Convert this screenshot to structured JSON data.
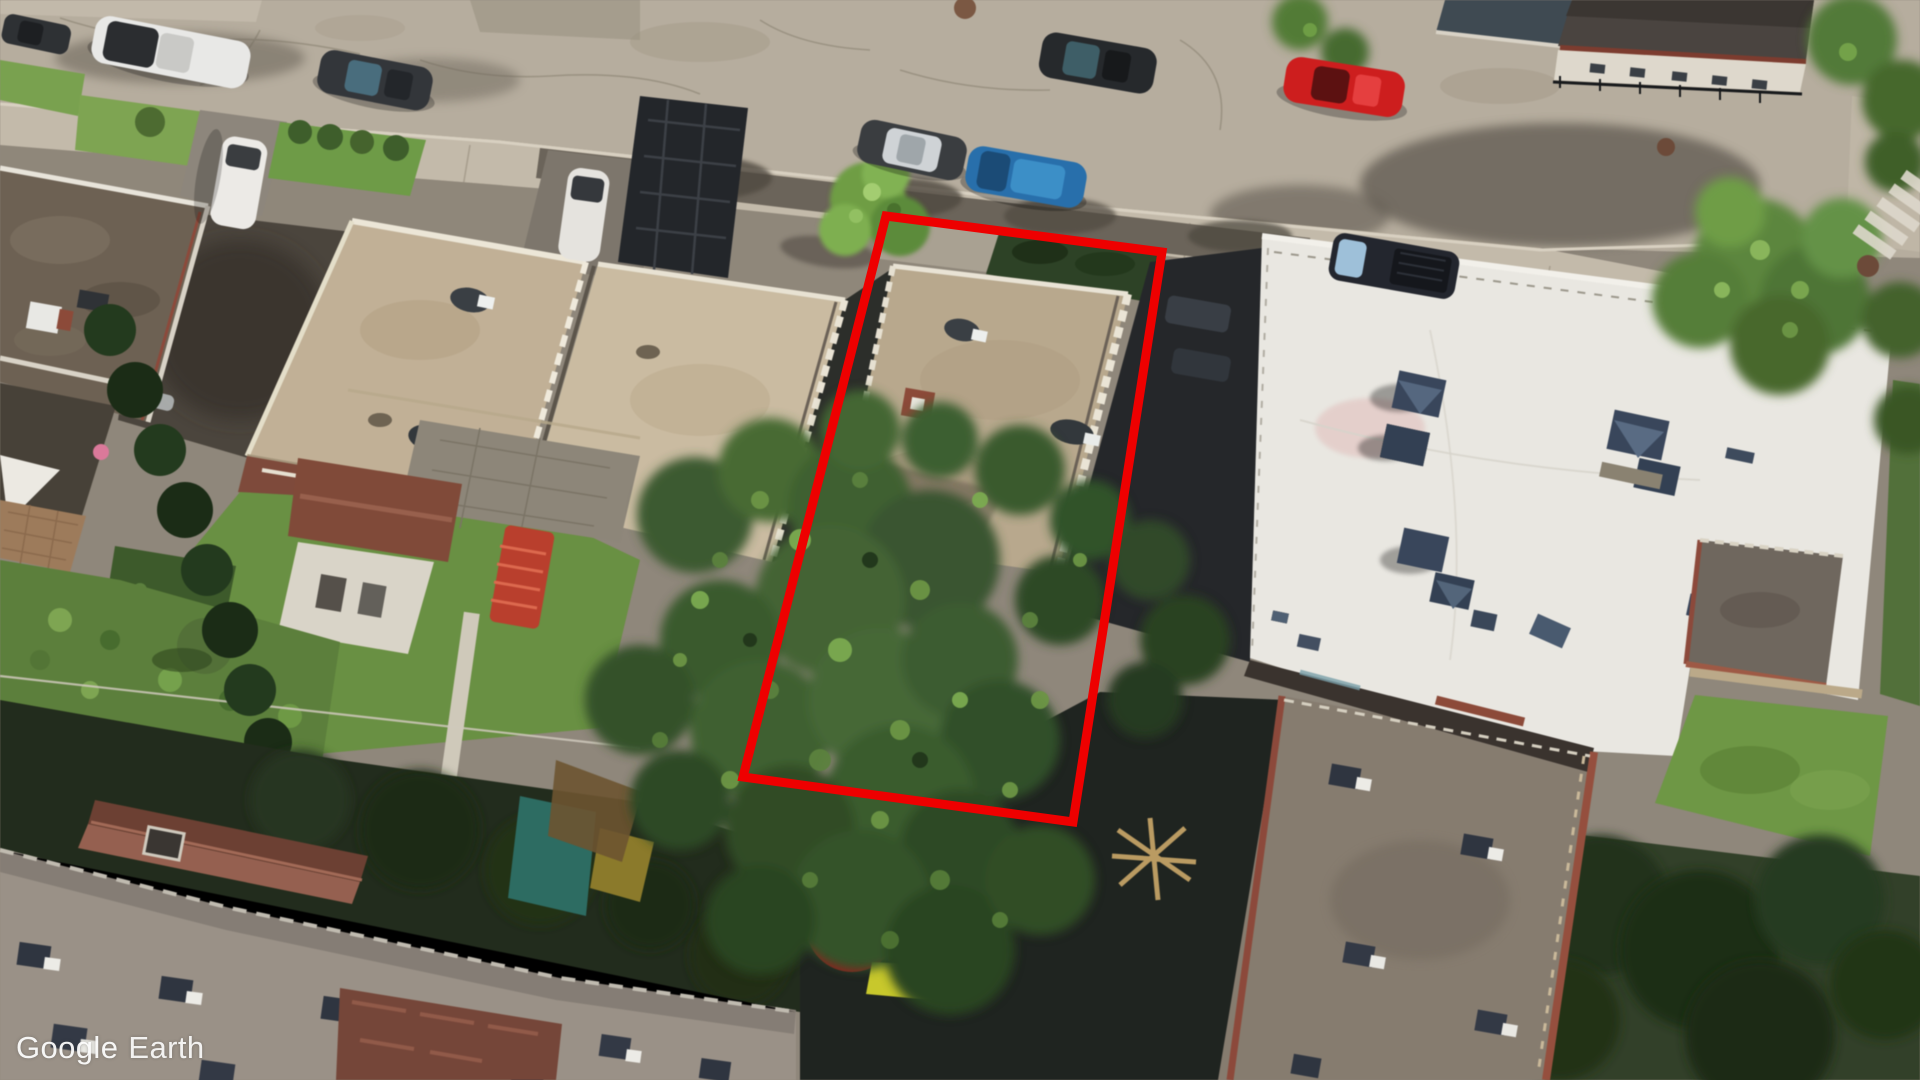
{
  "watermark": {
    "brand": "Google",
    "product": "Earth"
  },
  "annotation": {
    "name": "highlighted-property-outline",
    "shape": "quadrilateral",
    "color": "#ee0000",
    "stroke_width": 9
  },
  "scene": {
    "kind": "oblique-aerial-imagery",
    "setting": "residential-city-block",
    "palette": {
      "street": "#b6ad9f",
      "sidewalk": "#c3baab",
      "tan_roof": "#c0b097",
      "white_roof": "#e9e7e1",
      "gray_roof": "#9a9187",
      "brown_shed_roof": "#8a5444",
      "lawn": "#6a8f45",
      "tree_canopy": "#3e5a31",
      "deep_shadow": "#25272a",
      "annotation_red": "#ee0000"
    },
    "vehicles": [
      {
        "type": "sedan",
        "color": "#2e3134"
      },
      {
        "type": "sedan",
        "color": "#e8e8e6"
      },
      {
        "type": "sedan",
        "color": "#33363a"
      },
      {
        "type": "van",
        "color": "#eceae6"
      },
      {
        "type": "sedan",
        "color": "#e5e3de"
      },
      {
        "type": "sedan",
        "color": "#3a3d40"
      },
      {
        "type": "minivan",
        "color": "#2a6fa8"
      },
      {
        "type": "suv",
        "color": "#26292c"
      },
      {
        "type": "sedan",
        "color": "#c81f1f"
      },
      {
        "type": "pickup",
        "color": "#23262e"
      }
    ]
  }
}
